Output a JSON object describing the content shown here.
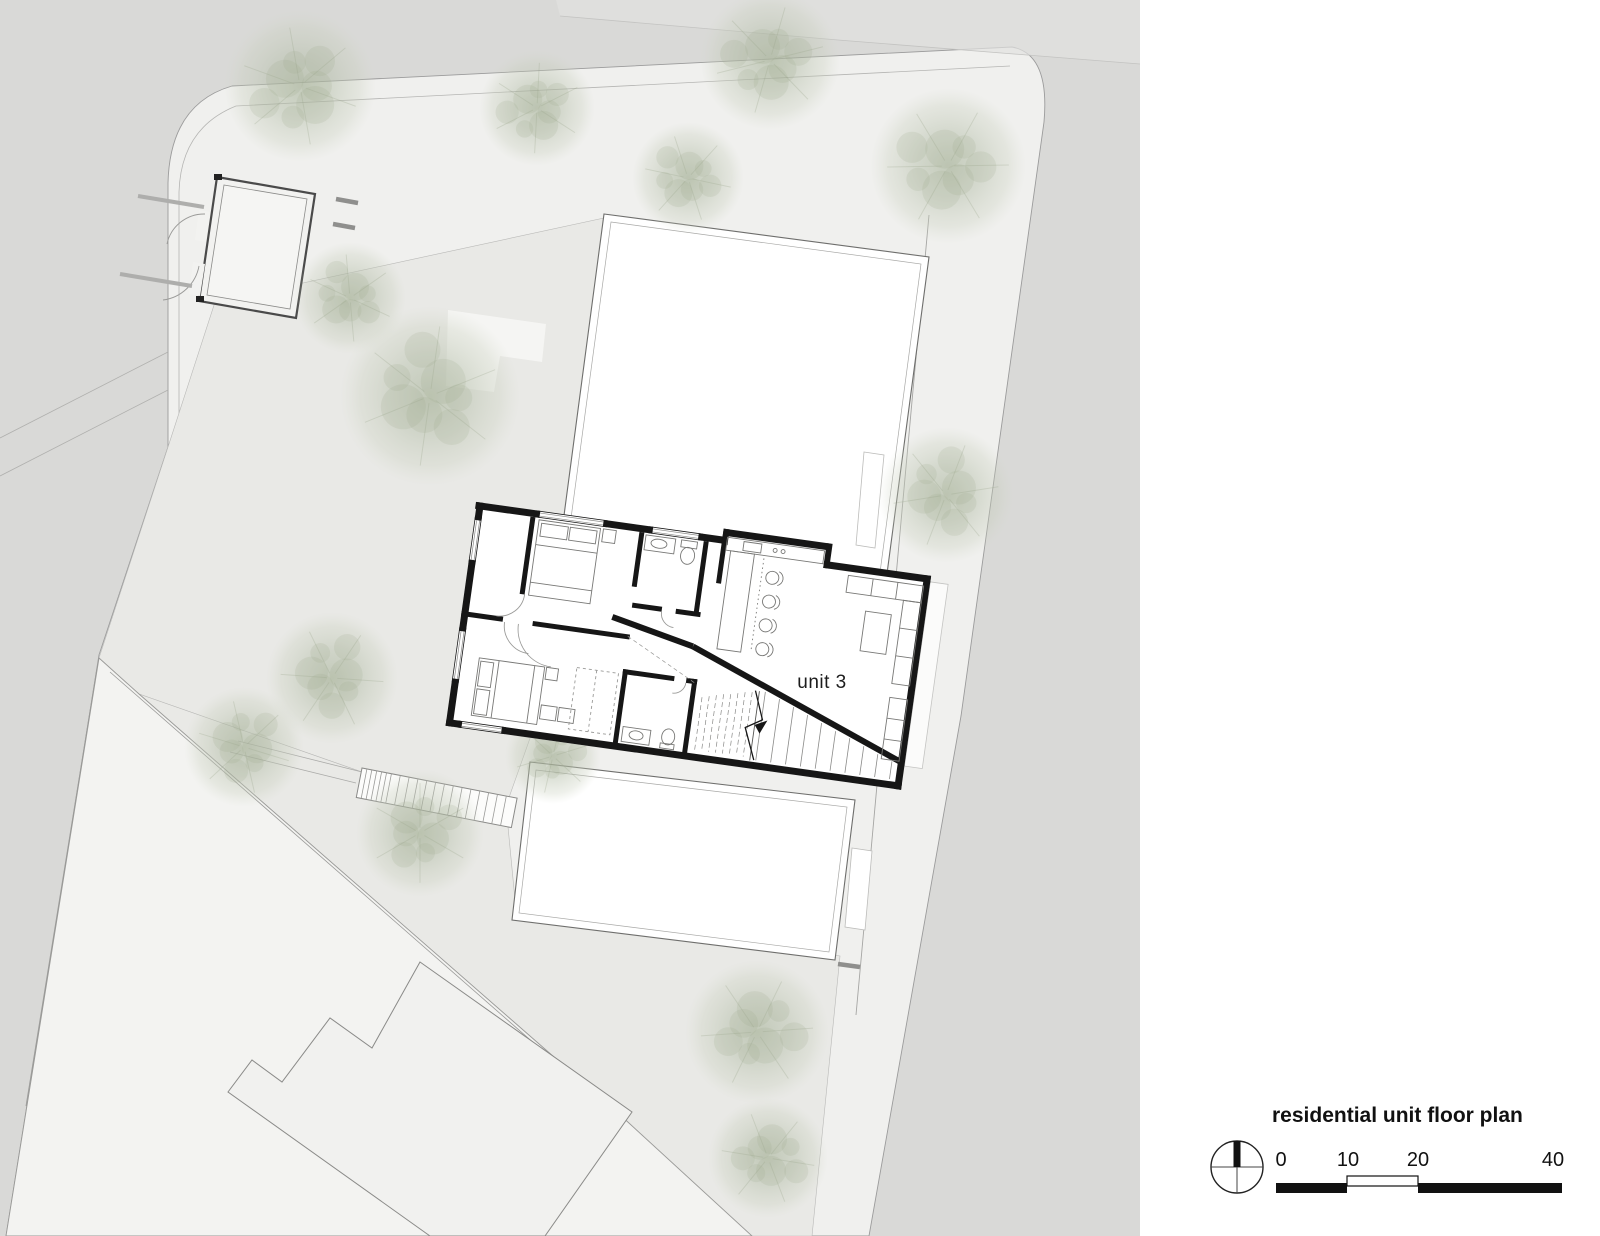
{
  "legend": {
    "title": "residential unit floor plan",
    "scale_labels": [
      "0",
      "10",
      "20",
      "40"
    ],
    "north_icon": "north-arrow-icon"
  },
  "plan": {
    "unit_label": "unit 3"
  },
  "colors": {
    "canvas_gray": "#d9d9d7",
    "street": "#f0f0ee",
    "courtyard": "#e9e9e6",
    "parcel": "#f3f3f1",
    "building_fill": "#ffffff",
    "wall_black": "#161616",
    "outline_gray": "#8a8a8a",
    "tree_green": "#b7c0ab",
    "furniture_gray": "#787878"
  }
}
